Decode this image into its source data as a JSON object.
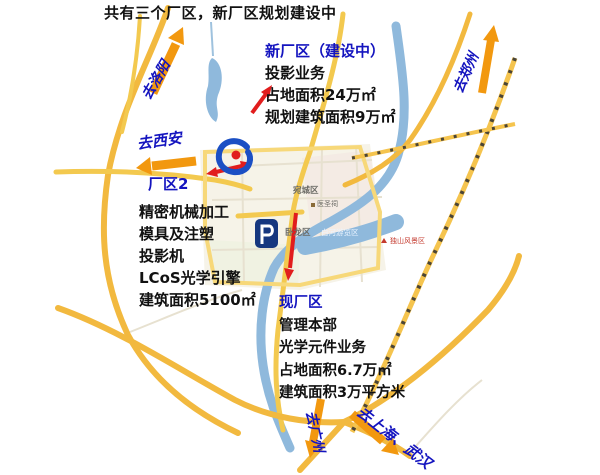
{
  "title": "共有三个厂区，新厂区规划建设中",
  "colors": {
    "accent_blue": "#1414bf",
    "arrow_red": "#e11d1d",
    "arrow_orange": "#f2980f",
    "road_yellow": "#f3c94f",
    "highway_orange": "#f0a93a",
    "river_blue": "#8fb9dc",
    "text_black": "#111111"
  },
  "annotations": {
    "new_plant": {
      "title": "新厂区（建设中）",
      "lines": [
        "投影业务",
        "占地面积24万㎡",
        "规划建筑面积9万㎡"
      ]
    },
    "plant2": {
      "title": "厂区2",
      "lines": [
        "精密机械加工",
        "模具及注塑",
        "投影机",
        "LCoS光学引擎",
        "建筑面积5100㎡"
      ]
    },
    "current_plant": {
      "title": "现厂区",
      "lines": [
        "管理本部",
        "光学元件业务",
        "占地面积6.7万㎡",
        "建筑面积3万平方米"
      ]
    }
  },
  "directions": {
    "luoyang": "去洛阳",
    "zhengzhou": "去郑州",
    "xian": "去西安",
    "guangzhou": "去广州",
    "shanghai_wuhan": "去上海、武汉"
  },
  "map_labels": {
    "district_wancheng": "宛城区",
    "district_wolong": "卧龙区",
    "river": "白河游览区",
    "poi_yishengci": "医圣祠",
    "poi_dushan": "独山风景区"
  },
  "icons": {
    "swirl_logo": "blue-swirl-with-red-dot",
    "p_badge_logo": "blue-badge-letter-P",
    "p_badge_letter": "P"
  }
}
